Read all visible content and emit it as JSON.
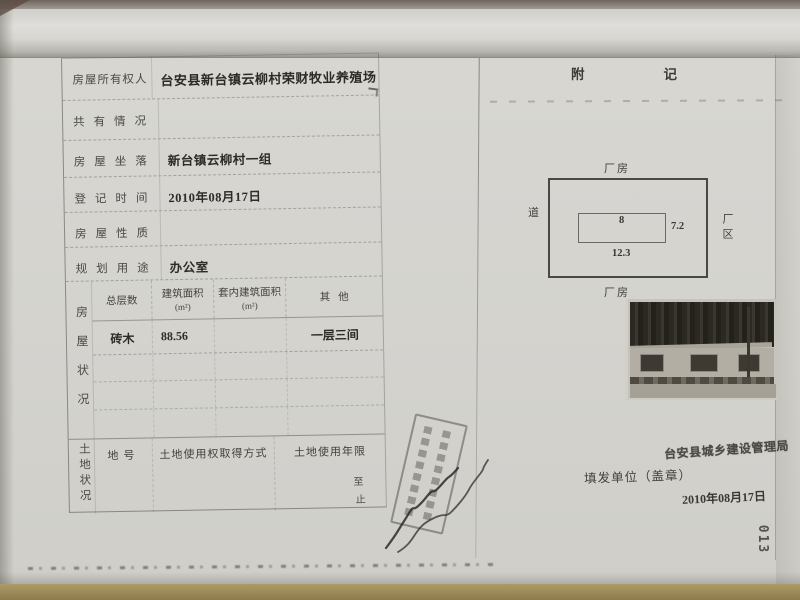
{
  "form": {
    "rows": [
      {
        "label": "房屋所有权人",
        "value": "台安县新台镇云柳村荣财牧业养殖场"
      },
      {
        "label": "共有情况",
        "value": ""
      },
      {
        "label": "房屋坐落",
        "value": "新台镇云柳村一组"
      },
      {
        "label": "登记时间",
        "value": "2010年08月17日"
      },
      {
        "label": "房屋性质",
        "value": ""
      },
      {
        "label": "规划用途",
        "value": "办公室"
      }
    ],
    "house_status": {
      "side_label": "房屋状况",
      "columns": [
        {
          "line1": "总层数",
          "line2": ""
        },
        {
          "line1": "建筑面积",
          "line2": "(m²)"
        },
        {
          "line1": "套内建筑面积",
          "line2": "(m²)"
        },
        {
          "line1": "其他",
          "line2": ""
        }
      ],
      "values": [
        "砖木",
        "88.56",
        "",
        "一层三间"
      ]
    },
    "land_status": {
      "side_label": "土地状况",
      "columns": [
        "地号",
        "土地使用权取得方式",
        "土地使用年限"
      ],
      "term_start": "至",
      "term_end": "止"
    }
  },
  "annex": {
    "header": "附记",
    "diagram": {
      "top_label": "厂房",
      "bottom_label": "厂房",
      "left_label": "道",
      "right_label": "厂区",
      "width_top": "8",
      "height_right": "7.2",
      "width_bottom": "12.3"
    },
    "authority": "台安县城乡建设管理局",
    "issue_unit_label": "填发单位（盖章）",
    "issue_date": "2010年08月17日",
    "page_number": "013"
  }
}
